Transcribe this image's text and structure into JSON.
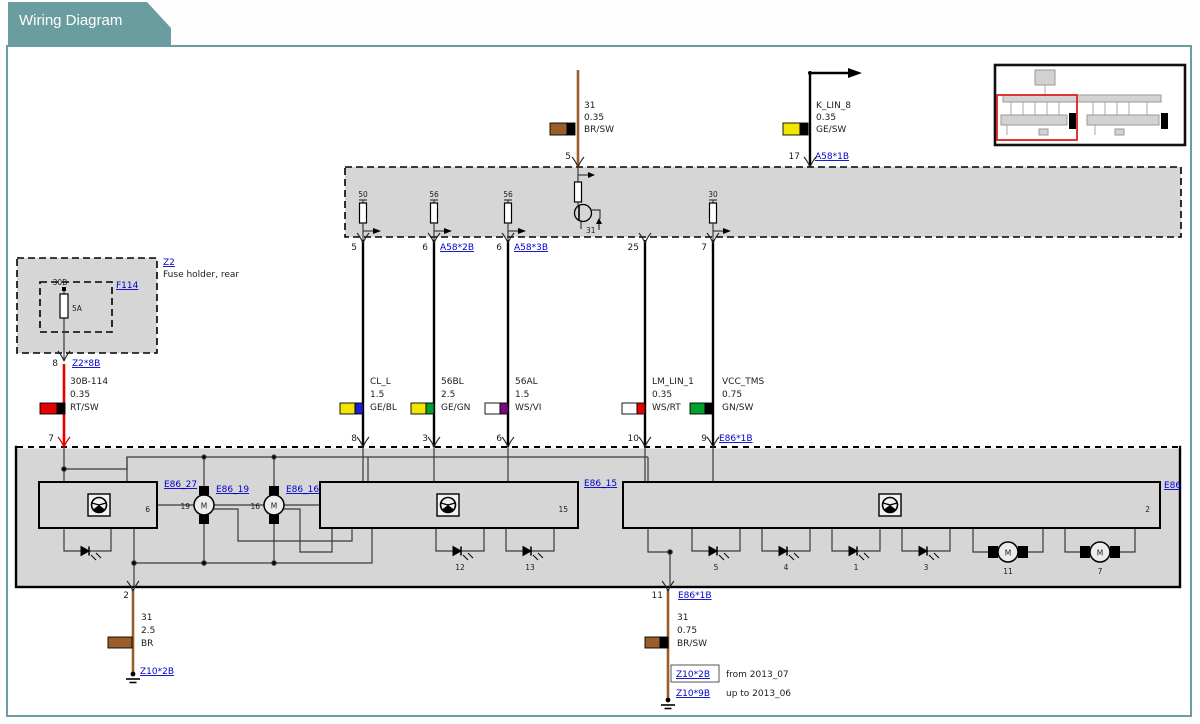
{
  "header": {
    "title": "Wiring Diagram"
  },
  "colors": {
    "teal": "#6a9da0",
    "link_blue": "#0000cd",
    "gray_fill": "#d6d6d6",
    "wire_black": "#000000",
    "wire_brown": "#9a5f28",
    "wire_red": "#e60000",
    "swatch_yellow": "#f2e600",
    "swatch_blue": "#1e1ecd",
    "swatch_green": "#00a12e",
    "swatch_violet": "#7d0a7d",
    "swatch_white": "#ffffff",
    "swatch_black": "#000000",
    "swatch_brown": "#9a5f28",
    "swatch_red": "#e60000",
    "viewport_red": "#dd2222"
  },
  "top_wires": {
    "w31": {
      "pin": "5",
      "label": "31",
      "gauge": "0.35",
      "color": "BR/SW"
    },
    "klin8": {
      "pin": "17",
      "label": "K_LIN_8",
      "gauge": "0.35",
      "color": "GE/SW",
      "connector": "A58*1B"
    }
  },
  "control_unit": {
    "r1": "50",
    "r2": "56",
    "r3": "56",
    "r4": "30",
    "transistor": "31",
    "pins": {
      "p5": "5",
      "p6a": "6",
      "c6a": "A58*2B",
      "p6b": "6",
      "c6b": "A58*3B",
      "p25": "25",
      "p7": "7"
    }
  },
  "fuse": {
    "box": "Z2",
    "caption": "Fuse holder, rear",
    "id": "F114",
    "terminal": "30B",
    "rating": "5A",
    "pin": "8",
    "connector": "Z2*8B"
  },
  "red_wire": {
    "label": "30B-114",
    "gauge": "0.35",
    "color": "RT/SW",
    "pin": "7"
  },
  "wires": [
    {
      "label": "CL_L",
      "gauge": "1.5",
      "color": "GE/BL",
      "pin_bottom": "8"
    },
    {
      "label": "56BL",
      "gauge": "2.5",
      "color": "GE/GN",
      "pin_bottom": "3"
    },
    {
      "label": "56AL",
      "gauge": "1.5",
      "color": "WS/VI",
      "pin_bottom": "6"
    },
    {
      "label": "LM_LIN_1",
      "gauge": "0.35",
      "color": "WS/RT",
      "pin_bottom": "10"
    },
    {
      "label": "VCC_TMS",
      "gauge": "0.75",
      "color": "GN/SW",
      "pin_bottom": "9",
      "connector": "E86*1B"
    }
  ],
  "module": {
    "c1_link": "E86_27",
    "c1_num": "6",
    "m19_link": "E86_19",
    "m19_num": "19",
    "m16_link": "E86_16",
    "m16_num": "16",
    "c2_link": "E86_15",
    "c2_num": "15",
    "c3_link": "E86",
    "c3_num": "2",
    "motor_letter": "M",
    "d12": "12",
    "d13": "13",
    "d5": "5",
    "d4": "4",
    "d1": "1",
    "d3": "3",
    "m11": "11",
    "m7": "7",
    "pin2": "2",
    "pin11": "11",
    "pin11_connector": "E86*1B"
  },
  "ground_left": {
    "label": "31",
    "gauge": "2.5",
    "color": "BR",
    "connector": "Z10*2B"
  },
  "ground_right": {
    "label": "31",
    "gauge": "0.75",
    "color": "BR/SW",
    "connector_new": "Z10*2B",
    "note_new": "from 2013_07",
    "connector_old": "Z10*9B",
    "note_old": "up to 2013_06"
  }
}
